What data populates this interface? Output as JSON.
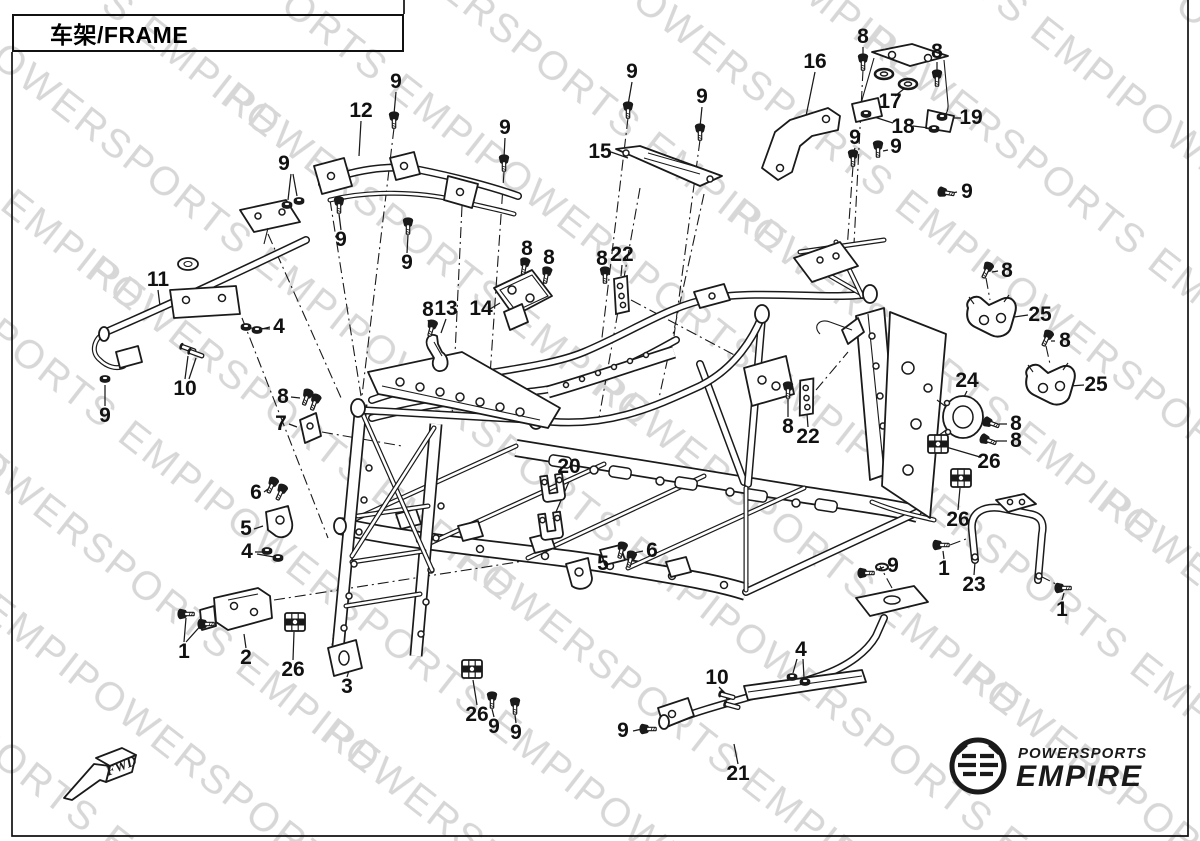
{
  "title": {
    "text": "车架/FRAME"
  },
  "watermark": {
    "text": "POWERSPORTS EMPIRE"
  },
  "fwd": {
    "label": "FWD"
  },
  "brand": {
    "name_top": "POWERSPORTS",
    "name_bottom": "EMPIRE"
  },
  "colors": {
    "ink": "#1a1a1a",
    "watermark": "#d7d7d7",
    "paper": "#ffffff"
  },
  "callouts": [
    {
      "label": "9"
    },
    {
      "label": "12"
    },
    {
      "label": "9"
    },
    {
      "label": "9"
    },
    {
      "label": "9"
    },
    {
      "label": "9"
    },
    {
      "label": "9"
    },
    {
      "label": "9"
    },
    {
      "label": "16"
    },
    {
      "label": "8"
    },
    {
      "label": "8"
    },
    {
      "label": "17"
    },
    {
      "label": "18"
    },
    {
      "label": "19"
    },
    {
      "label": "15"
    },
    {
      "label": "9"
    },
    {
      "label": "9"
    },
    {
      "label": "9"
    },
    {
      "label": "8"
    },
    {
      "label": "8"
    },
    {
      "label": "8"
    },
    {
      "label": "22"
    },
    {
      "label": "11"
    },
    {
      "label": "4"
    },
    {
      "label": "10"
    },
    {
      "label": "9"
    },
    {
      "label": "8"
    },
    {
      "label": "13"
    },
    {
      "label": "14"
    },
    {
      "label": "8"
    },
    {
      "label": "25"
    },
    {
      "label": "8"
    },
    {
      "label": "25"
    },
    {
      "label": "24"
    },
    {
      "label": "8"
    },
    {
      "label": "8"
    },
    {
      "label": "26"
    },
    {
      "label": "26"
    },
    {
      "label": "8"
    },
    {
      "label": "7"
    },
    {
      "label": "8"
    },
    {
      "label": "22"
    },
    {
      "label": "20"
    },
    {
      "label": "6"
    },
    {
      "label": "5"
    },
    {
      "label": "4"
    },
    {
      "label": "5"
    },
    {
      "label": "6"
    },
    {
      "label": "9"
    },
    {
      "label": "1"
    },
    {
      "label": "23"
    },
    {
      "label": "1"
    },
    {
      "label": "1"
    },
    {
      "label": "2"
    },
    {
      "label": "26"
    },
    {
      "label": "3"
    },
    {
      "label": "26"
    },
    {
      "label": "9"
    },
    {
      "label": "9"
    },
    {
      "label": "4"
    },
    {
      "label": "10"
    },
    {
      "label": "9"
    },
    {
      "label": "21"
    }
  ]
}
